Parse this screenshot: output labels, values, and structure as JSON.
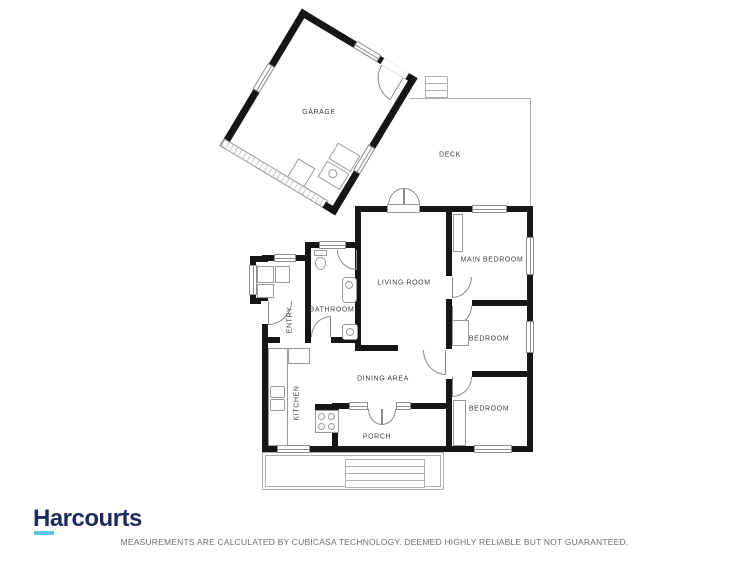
{
  "page": {
    "background": "#ffffff"
  },
  "branding": {
    "logo_text": "Harcourts",
    "logo_color": "#1c2b5a",
    "logo_underline_color": "#5ec3e8"
  },
  "footer": {
    "disclaimer": "MEASUREMENTS ARE CALCULATED BY CUBICASA TECHNOLOGY. DEEMED HIGHLY RELIABLE BUT NOT GUARANTEED."
  },
  "floorplan": {
    "wall_color": "#161616",
    "line_color": "#8e8e8e",
    "label_color": "#3c3c3c",
    "rooms": [
      {
        "id": "garage",
        "label": "GARAGE"
      },
      {
        "id": "deck",
        "label": "DECK"
      },
      {
        "id": "living-room",
        "label": "LIVING ROOM"
      },
      {
        "id": "main-bedroom",
        "label": "MAIN BEDROOM"
      },
      {
        "id": "bedroom-1",
        "label": "BEDROOM"
      },
      {
        "id": "bedroom-2",
        "label": "BEDROOM"
      },
      {
        "id": "bathroom",
        "label": "BATHROOM"
      },
      {
        "id": "entry",
        "label": "ENTRY"
      },
      {
        "id": "kitchen",
        "label": "KITCHEN"
      },
      {
        "id": "dining-area",
        "label": "DINING AREA"
      },
      {
        "id": "porch",
        "label": "PORCH"
      }
    ]
  }
}
